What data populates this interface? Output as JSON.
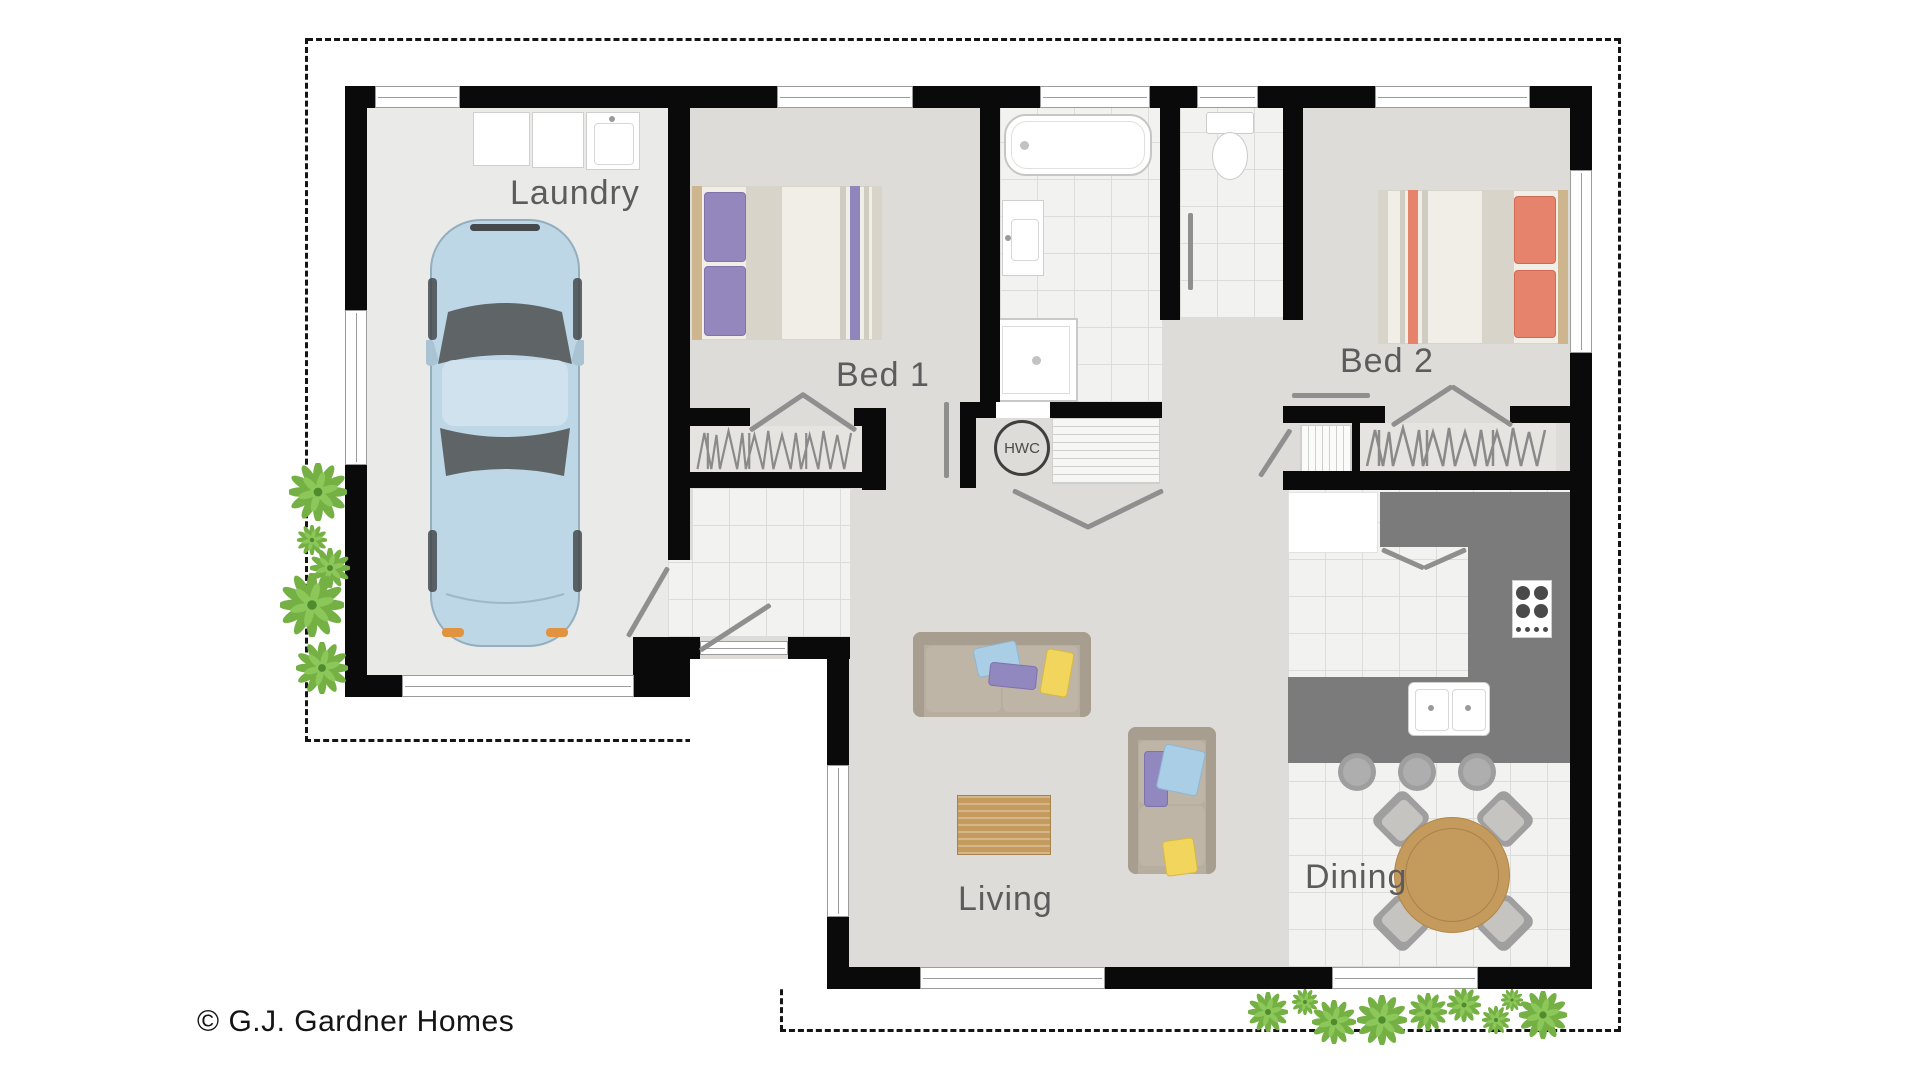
{
  "plan": {
    "copyright": "© G.J. Gardner Homes",
    "rooms": {
      "laundry": {
        "label": "Laundry"
      },
      "bed1": {
        "label": "Bed 1"
      },
      "bed2": {
        "label": "Bed 2"
      },
      "living": {
        "label": "Living"
      },
      "dining": {
        "label": "Dining"
      }
    },
    "fixtures": {
      "hot_water_cylinder_label": "HWC"
    },
    "colors": {
      "wall": "#0a0a0a",
      "garage_floor": "#eaeae9",
      "room_floor": "#dedcd9",
      "tile": "#f2f2f1",
      "tile_line": "#dcdcda",
      "counter": "#7b7b7b",
      "wood": "#c49a5d",
      "sofa": "#b7ae9f",
      "pillow_blue": "#a9cee6",
      "pillow_purple": "#9288c0",
      "pillow_yellow": "#f2d55c",
      "bed_pillow_purple": "#9487bd",
      "bed_pillow_coral": "#e5836d",
      "car_body": "#bdd7e6",
      "plant_green": "#74b043",
      "door": "#8f8f8f",
      "label_text": "#5c5c5c"
    }
  }
}
